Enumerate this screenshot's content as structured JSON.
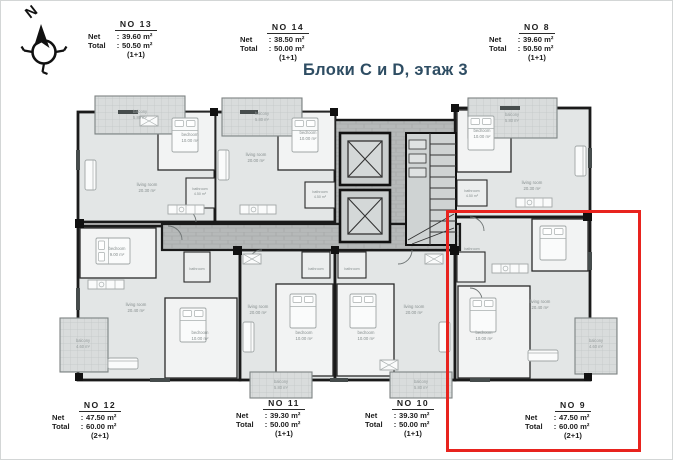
{
  "title": {
    "text": "Блоки C и D, этаж 3",
    "color": "#2e4d63"
  },
  "compass": {
    "letter": "N"
  },
  "labels": {
    "net": "Net",
    "total": "Total",
    "colon": ":"
  },
  "apartments": [
    {
      "no": "NO 13",
      "net": "39.60 m²",
      "total": "50.50 m²",
      "type": "(1+1)"
    },
    {
      "no": "NO 14",
      "net": "38.50 m²",
      "total": "50.00 m²",
      "type": "(1+1)"
    },
    {
      "no": "NO 8",
      "net": "39.60 m²",
      "total": "50.50 m²",
      "type": "(1+1)"
    },
    {
      "no": "NO 12",
      "net": "47.50 m²",
      "total": "60.00 m²",
      "type": "(2+1)"
    },
    {
      "no": "NO 11",
      "net": "39.30 m²",
      "total": "50.00 m²",
      "type": "(1+1)"
    },
    {
      "no": "NO 10",
      "net": "39.30 m²",
      "total": "50.00 m²",
      "type": "(1+1)"
    },
    {
      "no": "NO 9",
      "net": "47.50 m²",
      "total": "60.00 m²",
      "type": "(2+1)"
    }
  ],
  "rooms": {
    "balcony": "balcony",
    "bedroom": "bedroom",
    "living": "living room",
    "bathroom": "bathroom",
    "area_580": "5.80 m²",
    "area_460": "4.60 m²",
    "area_1000": "10.00 m²",
    "area_900": "9.00 m²",
    "area_2030": "20.30 m²",
    "area_2000": "20.00 m²",
    "area_2040": "20.40 m²",
    "area_450": "4.50 m²"
  },
  "highlight": {
    "color": "#e8231e",
    "target_apartment": "NO 9"
  },
  "colors": {
    "wall": "#1a1a1a",
    "room_fill": "#e3e6e6",
    "corridor_fill": "#b6b9b9",
    "balcony_fill": "#d9dcdc"
  }
}
